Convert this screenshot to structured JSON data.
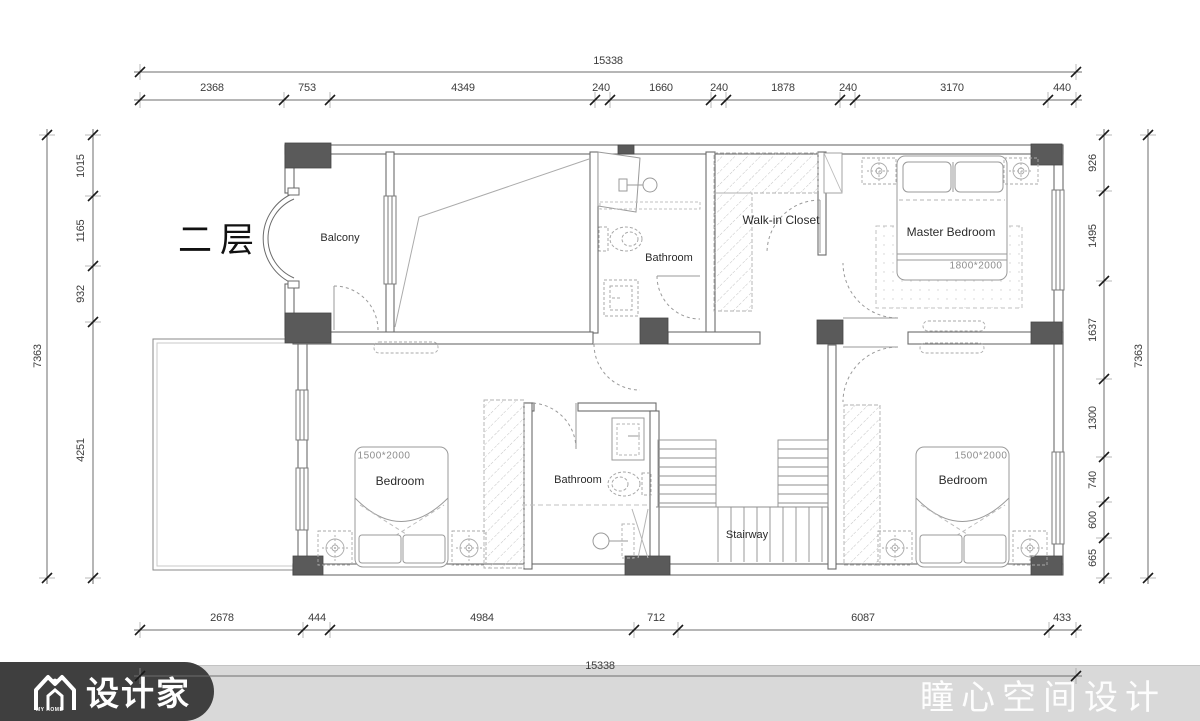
{
  "page": {
    "title": "二层"
  },
  "rooms": {
    "balcony": "Balcony",
    "bathroom_top": "Bathroom",
    "walkin_closet": "Walk-in Closet",
    "master_bedroom": "Master Bedroom",
    "master_bed_size": "1800*2000",
    "bedroom_left": "Bedroom",
    "bedroom_left_size": "1500*2000",
    "bathroom_bottom": "Bathroom",
    "stairway": "Stairway",
    "bedroom_right": "Bedroom",
    "bedroom_right_size": "1500*2000"
  },
  "dimensions": {
    "top_total": "15338",
    "top_segments": [
      "2368",
      "753",
      "4349",
      "240",
      "1660",
      "240",
      "1878",
      "240",
      "3170",
      "440"
    ],
    "bottom_segments": [
      "2678",
      "444",
      "4984",
      "712",
      "6087",
      "433"
    ],
    "bottom_total": "15338",
    "left_total": "7363",
    "left_segments": [
      "1015",
      "1165",
      "932",
      "4251"
    ],
    "right_total": "7363",
    "right_segments": [
      "926",
      "1495",
      "1637",
      "1300",
      "740",
      "600",
      "665"
    ]
  },
  "footer": {
    "brand": "设计家",
    "brand_tagline": "MY HOME",
    "studio": "瞳心空间设计"
  },
  "colors": {
    "pillar": "#5a5a5a",
    "wall_line": "#6b6b6b",
    "footer_bar": "#d9d9d9",
    "footer_pill": "#3f3f3f",
    "dim_text": "#3c3c3c"
  }
}
